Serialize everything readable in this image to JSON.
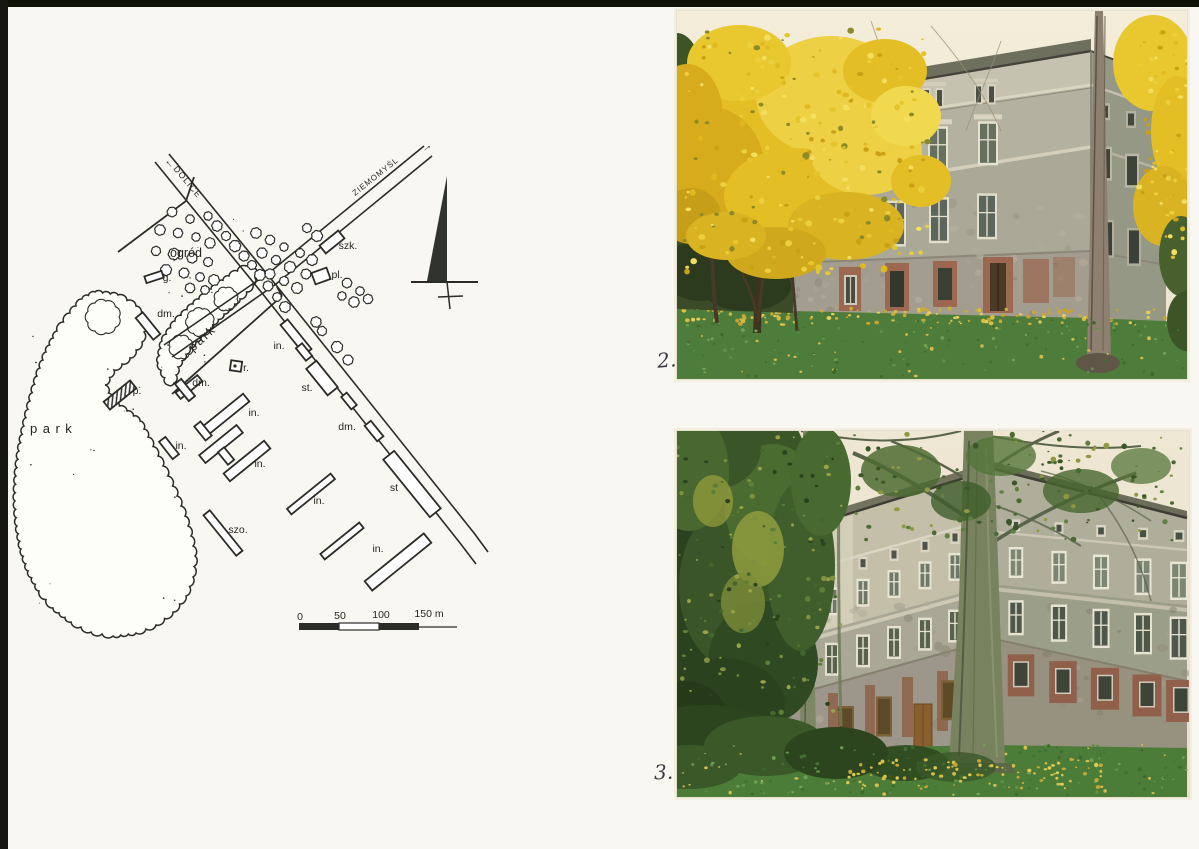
{
  "map": {
    "road_labels": [
      {
        "text": "DOLICE",
        "arrow": "←"
      },
      {
        "text": "ZIEMOMYŚL",
        "arrow": "→"
      }
    ],
    "area_labels": [
      {
        "text": "ogród"
      },
      {
        "text": "park"
      },
      {
        "text": "park"
      }
    ],
    "building_labels": [
      "g.",
      "dm.",
      "dm.",
      "p.",
      "r.",
      "in.",
      "in.",
      "in.",
      "szk.",
      "pl.",
      "in.",
      "st.",
      "dm.",
      "st",
      "szo.",
      "in.",
      "in."
    ],
    "scale_bar": {
      "ticks": [
        "0",
        "50",
        "100",
        "150 m"
      ]
    }
  },
  "photos": [
    {
      "caption": "2."
    },
    {
      "caption": "3."
    }
  ]
}
